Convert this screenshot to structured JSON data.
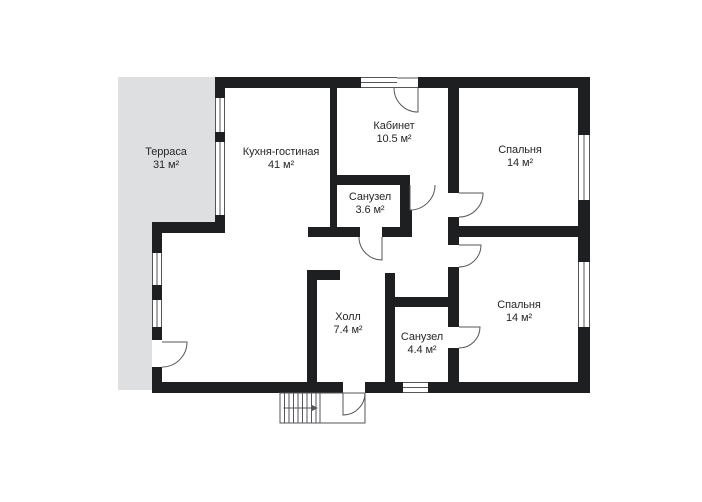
{
  "plan": {
    "title": "floor-plan",
    "colors": {
      "wall": "#1e1f21",
      "terrace": "#dedfe1",
      "line": "#55565a",
      "text": "#272727",
      "bg": "#ffffff"
    }
  },
  "rooms": [
    {
      "name": "Терраса",
      "area": "31 м²"
    },
    {
      "name": "Кухня-гостиная",
      "area": "41 м²"
    },
    {
      "name": "Кабинет",
      "area": "10.5 м²"
    },
    {
      "name": "Спальня",
      "area": "14 м²"
    },
    {
      "name": "Санузел",
      "area": "3.6 м²"
    },
    {
      "name": "Холл",
      "area": "7.4 м²"
    },
    {
      "name": "Санузел",
      "area": "4.4 м²"
    },
    {
      "name": "Спальня",
      "area": "14 м²"
    }
  ]
}
